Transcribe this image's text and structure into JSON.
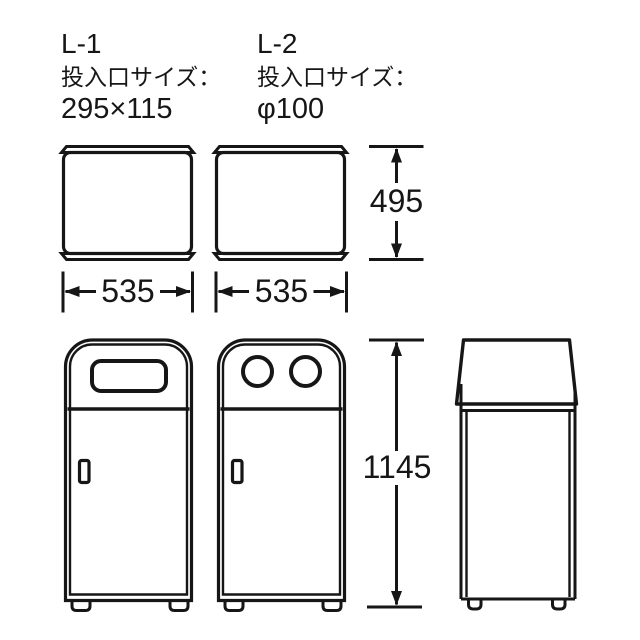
{
  "diagram": {
    "background": "#ffffff",
    "line_color": "#161616",
    "products": [
      {
        "model": "L-1",
        "opening_label": "投入口サイズ：",
        "opening_size": "295×115"
      },
      {
        "model": "L-2",
        "opening_label": "投入口サイズ：",
        "opening_size": "φ100"
      }
    ],
    "measurements": {
      "body_height": "495",
      "l1_body_width": "535",
      "l2_body_width": "535",
      "overall_height": "1145"
    }
  }
}
